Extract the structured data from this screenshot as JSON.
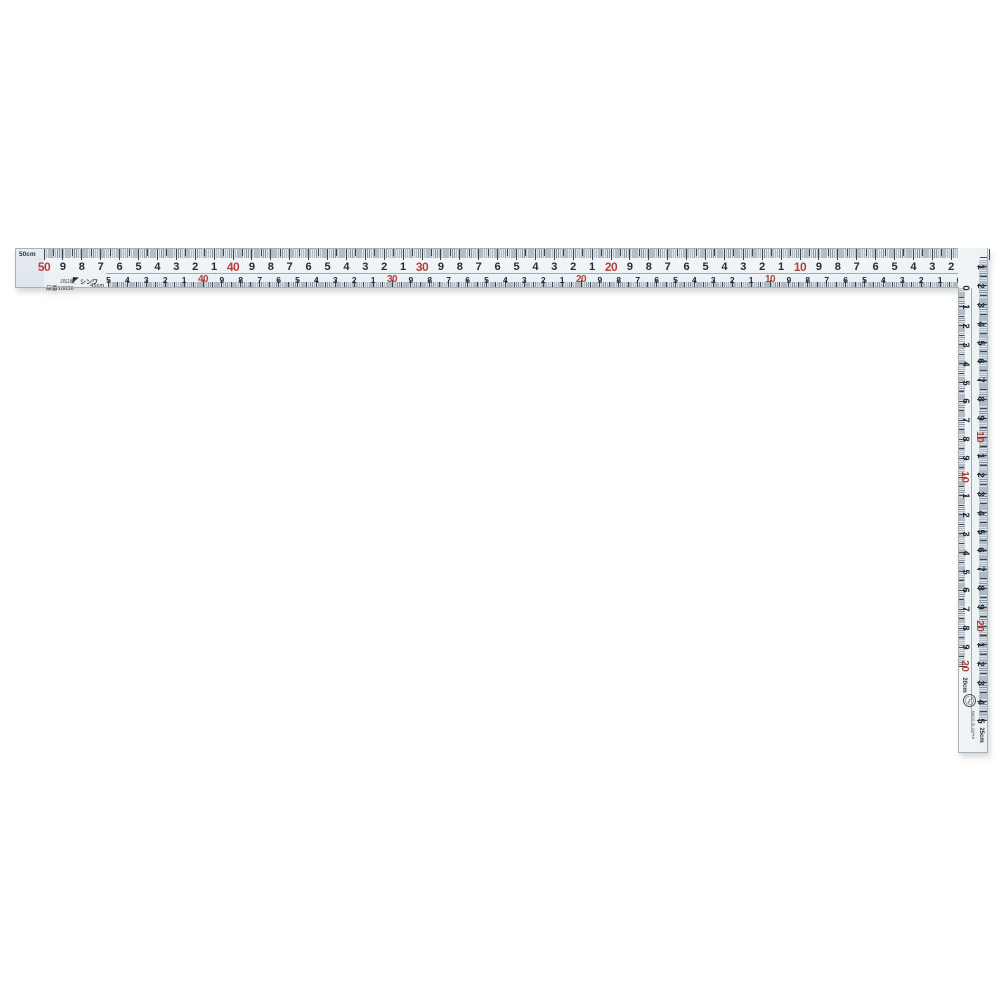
{
  "product": {
    "brand": "シンワ",
    "grade_mark": "JIS1級",
    "model_label": "品番10036",
    "jis_symbol": "〄",
    "made_in_label": "MADE IN JAPAN"
  },
  "long_arm": {
    "corner_label": "50cm",
    "top_scale": {
      "unit": "cm",
      "start": 50,
      "end": 0,
      "red_numbers": [
        50,
        40,
        30,
        20,
        10
      ],
      "minor_ticks": "mm"
    },
    "bottom_scale": {
      "unit": "cm",
      "start": 45,
      "end": 0,
      "start_label": "45cm",
      "red_numbers": [
        40,
        30,
        20,
        10
      ],
      "minor_ticks": "mm"
    }
  },
  "short_arm": {
    "outer_scale": {
      "unit": "cm",
      "start": 0,
      "end": 25,
      "end_label": "25cm",
      "red_numbers": [
        10,
        20
      ],
      "minor_ticks": "mm"
    },
    "inner_scale": {
      "unit": "cm",
      "start": 0,
      "end": 20,
      "end_label": "20cm",
      "red_numbers": [
        10,
        20
      ],
      "minor_ticks": "mm"
    }
  },
  "colors": {
    "blade": "#eff3f6",
    "tick": "#3c4650",
    "digit": "#262a33",
    "red_digit": "#b2423a",
    "edge": "#a7b1b9"
  }
}
